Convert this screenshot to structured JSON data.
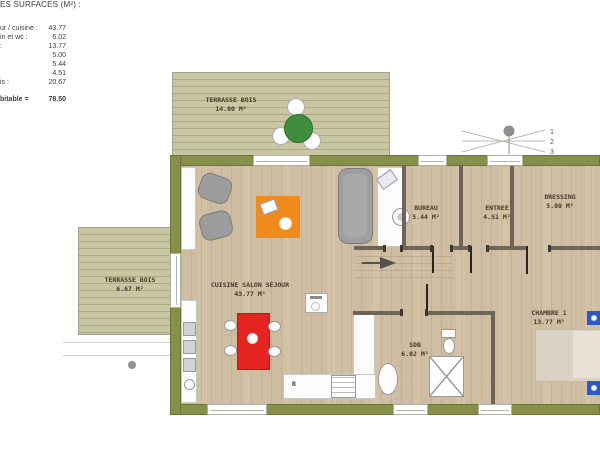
{
  "surface_table": {
    "title": "ES SURFACES (M²) :",
    "rows": [
      {
        "label": "ur / cuisine :",
        "value": "43.77"
      },
      {
        "label": "in et wc :",
        "value": "6.02"
      },
      {
        "label": ":",
        "value": "13.77"
      },
      {
        "label": "",
        "value": "5.00"
      },
      {
        "label": "",
        "value": "5.44"
      },
      {
        "label": "",
        "value": "4.51"
      },
      {
        "label": "is :",
        "value": "20.67"
      }
    ],
    "total_label": "bitable =",
    "total_value": "78.50"
  },
  "rooms": {
    "terrasse_haut": {
      "name": "TERRASSE BOIS",
      "area": "14.00 M²"
    },
    "terrasse_gauche": {
      "name": "TERRASSE BOIS",
      "area": "6.67 M²"
    },
    "sejour": {
      "name": "CUISINE SALON SÉJOUR",
      "area": "43.77 M²"
    },
    "bureau": {
      "name": "BUREAU",
      "area": "5.44 M²"
    },
    "entree": {
      "name": "ENTREE",
      "area": "4.51 M²"
    },
    "dressing": {
      "name": "DRESSING",
      "area": "5.00 M²"
    },
    "sdb": {
      "name": "SDB",
      "area": "6.02 M²"
    },
    "chambre1": {
      "name": "CHAMBRE 1",
      "area": "13.77 M²"
    }
  },
  "annotations": {
    "window_marker": [
      "1",
      "2",
      "3"
    ],
    "fridge": "R"
  },
  "colors": {
    "wall_olive": "#87904a",
    "deck": "#c9c6a3",
    "floor": "#d7c8af",
    "partition": "#6e6457",
    "rug_orange": "#ef8a1c",
    "table_red": "#e42420",
    "table_green": "#3f8e3d",
    "nightstand_blue": "#2e59c9",
    "furniture_gray": "#9c9c9c"
  }
}
